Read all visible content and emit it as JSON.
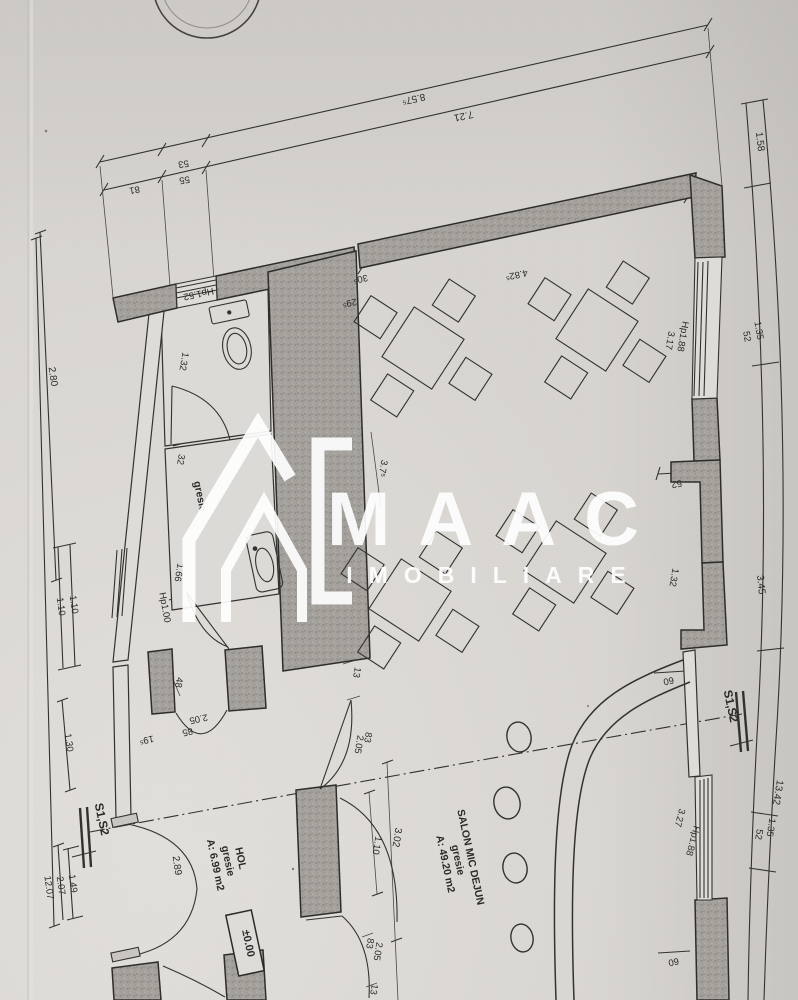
{
  "document_type": "floor-plan-scan",
  "watermark": {
    "brand": "MAAC",
    "subtitle": "IMOBILIARE"
  },
  "rooms": {
    "hol": {
      "name": "HOL",
      "finish": "gresie",
      "area": "A: 6.99 m2"
    },
    "salon": {
      "name": "SALON MIC DEJUN",
      "finish": "gresie",
      "area": "A: 49.20 m2"
    },
    "wc": {
      "finish": "gresie"
    }
  },
  "elevation": "±0.00",
  "sections": {
    "left": "S1,S2",
    "right": "S1,S2"
  },
  "dims": {
    "top_total": "8.57⁵",
    "top_inner": "7.21",
    "seg81": "81",
    "seg55": "55",
    "seg53": "53",
    "r158": "1.58",
    "r135a": "1.35",
    "r52a": "52",
    "r345": "3.45",
    "r1342": "13.42",
    "r135b": "1.35",
    "r52b": "52",
    "l280": "2.80",
    "l110a": "1.10",
    "l110b": "1.10",
    "l130": "1.30",
    "l149": "1.49",
    "l207": "2.07",
    "l1207": "12.07",
    "hp152": "Hp1.52",
    "wc132": "1.32",
    "wc32": "32",
    "wc166": "1.66",
    "hp100": "Hp1.00",
    "h48": "48",
    "h205": "2.05",
    "h85": "85",
    "h195": "19⁵",
    "h289": "2.89",
    "s4825": "4.82⁵",
    "s305": "30⁵",
    "s295": "29⁵",
    "s375": "3.7⁵",
    "s110": "1.10",
    "s302": "3.02",
    "d1_83": "83",
    "d1_205": "2.05",
    "d1_13": "13",
    "d2_83": "83",
    "d2_205": "2.05",
    "d2_13": "13",
    "rw_hp188a": "Hp1.88",
    "rw317": "3.17",
    "rw52": "52",
    "rw132": "1.32",
    "rw60a": "60",
    "rw327": "3.27",
    "rw_hp188b": "Hp1.88",
    "rw60b": "60"
  }
}
